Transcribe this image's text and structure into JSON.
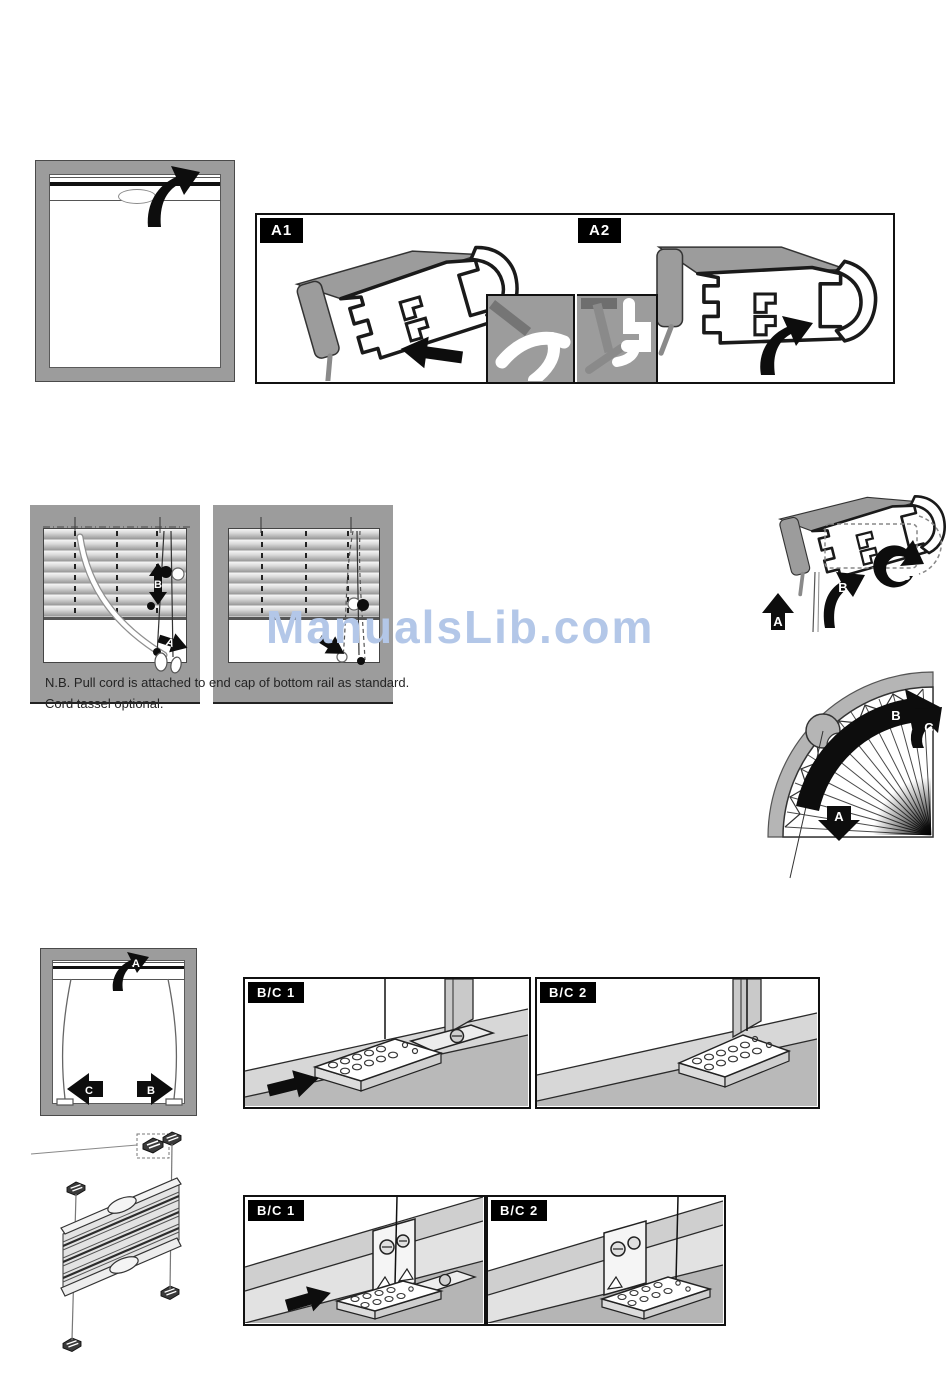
{
  "watermark": {
    "text": "ManualsLib.com",
    "color": "#b3c7e8"
  },
  "note": {
    "line1": "N.B. Pull cord is attached to end cap of bottom rail as standard.",
    "line2": "Cord tassel optional."
  },
  "panels": {
    "a1": "A1",
    "a2": "A2",
    "bc1": "B/C 1",
    "bc2": "B/C 2"
  },
  "letters": {
    "a": "A",
    "b": "B",
    "c": "C"
  },
  "colors": {
    "frame_gray": "#9c9c9c",
    "sill_light": "#d7d7d7",
    "sill_mid": "#b9b9b9",
    "outline": "#1a1a1a",
    "watermark_blue": "#b3c7e8"
  }
}
